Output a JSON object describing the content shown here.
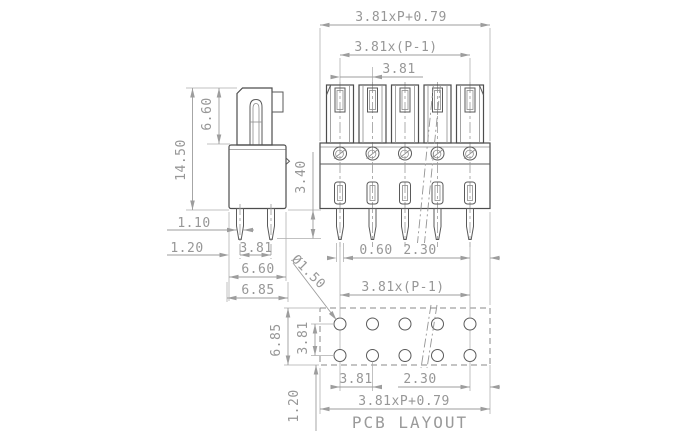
{
  "drawing": {
    "front": {
      "overall": "3.81xP+0.79",
      "span": "3.81x(P-1)",
      "pitch": "3.81",
      "pin_width": "0.60",
      "edge_offset": "2.30"
    },
    "side": {
      "height": "14.50",
      "tower_height": "6.60",
      "pin_thickness": "1.10",
      "pin_offset": "1.20",
      "pitch": "3.81",
      "body_width": "6.60",
      "overall_width": "6.85",
      "pin_length": "3.40"
    },
    "pcb": {
      "hole_diameter": "Ø1.50",
      "span": "3.81x(P-1)",
      "height": "6.85",
      "row_pitch": "3.81",
      "pitch": "3.81",
      "edge_offset": "2.30",
      "bottom_margin": "1.20",
      "overall": "3.81xP+0.79",
      "label": "PCB LAYOUT"
    }
  }
}
